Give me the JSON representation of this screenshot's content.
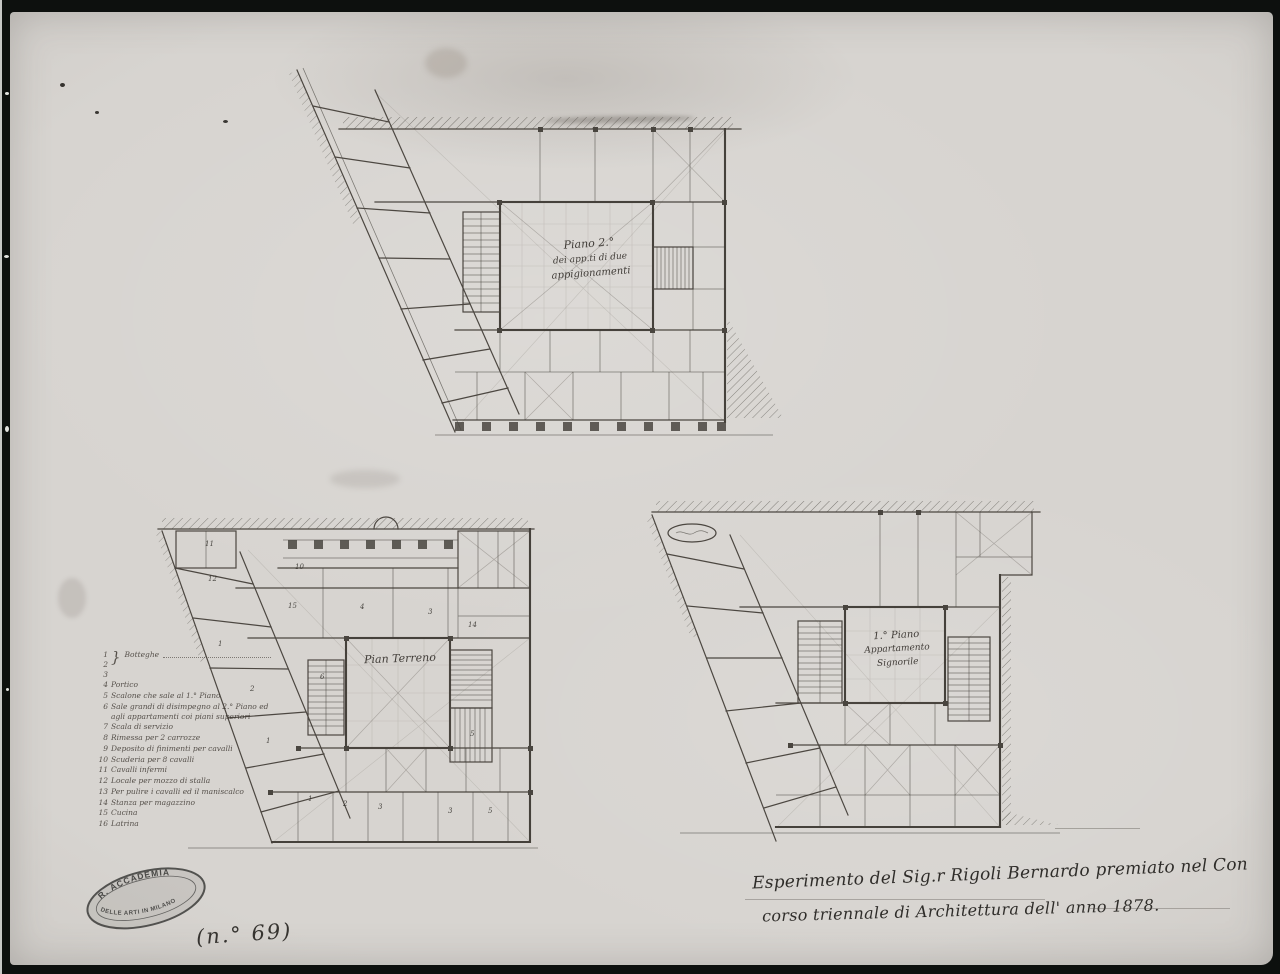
{
  "photo": {
    "border_color": "#0d100e",
    "paper_color": "#d7d4d0",
    "ink_color": "#45413b"
  },
  "plans": {
    "second_floor": {
      "label_lines": [
        "Piano 2.°",
        "dei app.ti di due",
        "appigionamenti"
      ]
    },
    "ground_floor": {
      "label": "Pian Terreno",
      "room_numbers": [
        "11",
        "12",
        "10",
        "15",
        "4",
        "3",
        "14",
        "1",
        "2",
        "1",
        "6",
        "5",
        "1",
        "2",
        "3",
        "3",
        "5"
      ]
    },
    "first_floor": {
      "label_lines": [
        "1.° Piano",
        "Appartamento",
        "Signorile"
      ]
    }
  },
  "legend": {
    "brace": "}",
    "items": [
      {
        "num": "1\n2\n3",
        "text": "Botteghe"
      },
      {
        "num": "4",
        "text": "Portico"
      },
      {
        "num": "5",
        "text": "Scalone che sale al 1.° Piano"
      },
      {
        "num": "6",
        "text": "Sale grandi di disimpegno al 2.° Piano ed agli appartamenti coi piani superiori"
      },
      {
        "num": "7",
        "text": "Scala di servizio"
      },
      {
        "num": "8",
        "text": "Rimessa per 2 carrozze"
      },
      {
        "num": "9",
        "text": "Deposito di finimenti per cavalli"
      },
      {
        "num": "10",
        "text": "Scuderia per 8 cavalli"
      },
      {
        "num": "11",
        "text": "Cavalli infermi"
      },
      {
        "num": "12",
        "text": "Locale per mozzo di stalla"
      },
      {
        "num": "13",
        "text": "Per pulire i cavalli ed il maniscalco"
      },
      {
        "num": "14",
        "text": "Stanza per magazzino"
      },
      {
        "num": "15",
        "text": "Cucina"
      },
      {
        "num": "16",
        "text": "Latrina"
      }
    ]
  },
  "caption": {
    "line1": "Esperimento del Sig.r Rigoli Bernardo premiato nel Con",
    "line2": "corso triennale di Architettura dell' anno 1878."
  },
  "stamp": {
    "top": "R. ACCADEMIA",
    "bottom": "DELLE ARTI IN MILANO"
  },
  "inventory_number": "(n.° 69)"
}
